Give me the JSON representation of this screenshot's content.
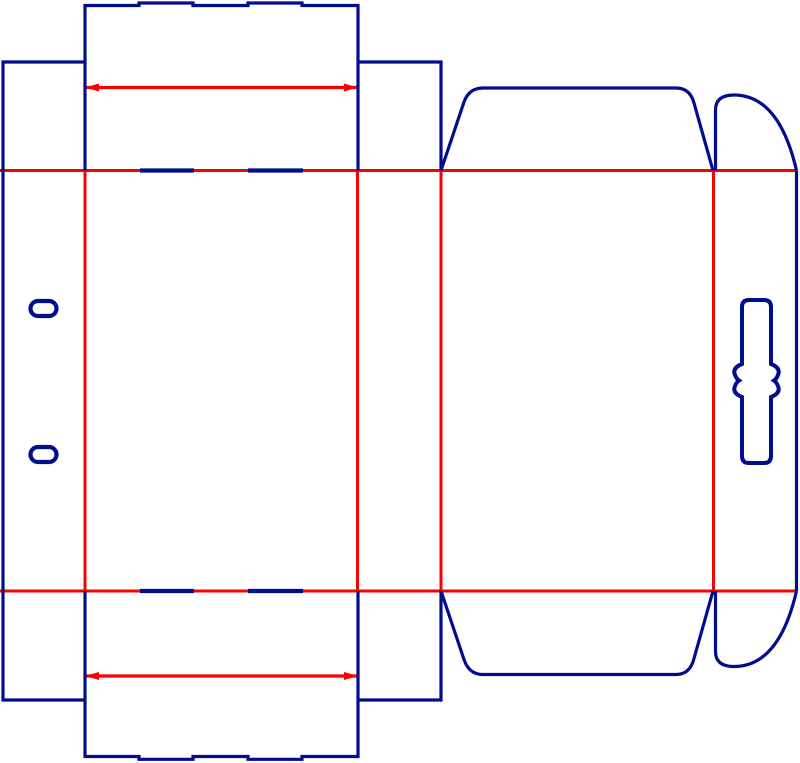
{
  "canvas": {
    "width": 800,
    "height": 763,
    "background": "#ffffff"
  },
  "colors": {
    "cut": "#000d8e",
    "crease": "#fa0000"
  },
  "shapes": [
    {
      "name": "main-crease-top",
      "stroke": "crease",
      "width": 3,
      "d": "M0,170.5 L796.5,170.5"
    },
    {
      "name": "main-crease-bottom",
      "stroke": "crease",
      "width": 3,
      "d": "M0,591 L796.5,591"
    },
    {
      "name": "vertical-crease-glue-front",
      "stroke": "crease",
      "width": 3,
      "d": "M85,170.5 L85,591"
    },
    {
      "name": "vertical-crease-front-side",
      "stroke": "crease",
      "width": 3,
      "d": "M357.5,170.5 L357.5,591"
    },
    {
      "name": "vertical-crease-side-back",
      "stroke": "crease",
      "width": 3,
      "d": "M441,170.5 L441,591"
    },
    {
      "name": "vertical-crease-back-hanger",
      "stroke": "crease",
      "width": 3,
      "d": "M713.5,170.5 L713.5,591"
    },
    {
      "name": "tuck-crease-top",
      "stroke": "crease",
      "width": 3.2,
      "d": "M85,87.5 L358,87.5"
    },
    {
      "name": "tuck-crease-bottom",
      "stroke": "crease",
      "width": 3.2,
      "d": "M85,676 L358,676"
    },
    {
      "name": "tuck-crease-top-arrow-left",
      "fill": "crease",
      "d": "M85,87.5 L99,83.5 L99,91.5 Z"
    },
    {
      "name": "tuck-crease-top-arrow-right",
      "fill": "crease",
      "d": "M358,87.5 L344,83.5 L344,91.5 Z"
    },
    {
      "name": "tuck-crease-bottom-arrow-left",
      "fill": "crease",
      "d": "M85,676 L99,672 L99,680 Z"
    },
    {
      "name": "tuck-crease-bottom-arrow-right",
      "fill": "crease",
      "d": "M358,676 L344,672 L344,680 Z"
    },
    {
      "name": "top-tuck-flap-outline",
      "stroke": "cut",
      "width": 3.2,
      "d": "M85,170.5 L85,5.5 L139,5.5 L139,3 L193,3 L193,5.5 L248,5.5 L248,3 L302,3 L302,5.5 L358,5.5 L358,170.5"
    },
    {
      "name": "bottom-tuck-flap-outline",
      "stroke": "cut",
      "width": 3.2,
      "d": "M85,591 L85,756.5 L139,756.5 L139,759.3 L193,759.3 L193,756.5 L248,756.5 L248,759.3 L302,759.3 L302,756.5 L358,756.5 L358,591"
    },
    {
      "name": "glue-column-outline",
      "stroke": "cut",
      "width": 3.2,
      "d": "M85,62 L3,62 L3,700 L85,700"
    },
    {
      "name": "top-right-dust-flap",
      "stroke": "cut",
      "width": 3.2,
      "d": "M358,62 L441,62 L441,170.5"
    },
    {
      "name": "bottom-right-dust-flap",
      "stroke": "cut",
      "width": 3.2,
      "d": "M358,700 L441,700 L441,591"
    },
    {
      "name": "back-top-flap-outline",
      "stroke": "cut",
      "width": 3.2,
      "d": "M441,170.5 L464,102 Q469,88 483,88 L676,88 Q690,88 694,103 L713,170.5"
    },
    {
      "name": "back-bottom-flap-outline",
      "stroke": "cut",
      "width": 3.2,
      "d": "M441,591 L464,659.5 Q469,674.5 483,674.5 L676,674.5 Q690,674.5 694,658.5 L713,591"
    },
    {
      "name": "top-ear-tab-outline",
      "stroke": "cut",
      "width": 3.2,
      "d": "M715.5,170.5 L715.5,110 Q715.5,95 734,95 Q779,95 796.5,170.5"
    },
    {
      "name": "bottom-ear-tab-outline",
      "stroke": "cut",
      "width": 3.2,
      "d": "M715.5,591 L715.5,651.5 Q715.5,666.5 734,666.5 Q779,666.5 796.5,591"
    },
    {
      "name": "hanger-right-edge",
      "stroke": "cut",
      "width": 3.2,
      "d": "M796.5,170.5 L796.5,591"
    },
    {
      "name": "hang-slot-cutout",
      "stroke": "cut",
      "width": 4,
      "d": "M749,300 L764,300 Q771,300 771,307 L771,364 Q780,367.5 778.5,373.5 Q777,378.5 774,380.5 Q777,382.5 778.5,387.5 Q780,393.5 771,397 L771,456 Q771,463 764,463 L749,463 Q742,463 742,456 L742,397 Q733,393.5 734.5,387.5 Q736,382.5 739,380.5 Q736,378.5 734.5,373.5 Q733,367.5 742,364 L742,307 Q742,300 749,300 Z"
    },
    {
      "name": "glue-slot-top",
      "stroke": "cut",
      "width": 4.2,
      "d": "M38,301 L49,301 A7.5,7.5 0 0 1 49,316 L38,316 A7.5,7.5 0 0 1 38,301 Z"
    },
    {
      "name": "glue-slot-bottom",
      "stroke": "cut",
      "width": 4.2,
      "d": "M38,447 L49,447 A7.5,7.5 0 0 1 49,462 L38,462 A7.5,7.5 0 0 1 38,447 Z"
    },
    {
      "name": "crease-cut-dash-top-left",
      "stroke": "cut",
      "width": 4.2,
      "d": "M140,170.5 L194,170.5"
    },
    {
      "name": "crease-cut-dash-top-right",
      "stroke": "cut",
      "width": 4.2,
      "d": "M248,170.5 L303,170.5"
    },
    {
      "name": "crease-cut-dash-bottom-left",
      "stroke": "cut",
      "width": 4.2,
      "d": "M140,591 L194,591"
    },
    {
      "name": "crease-cut-dash-bottom-right",
      "stroke": "cut",
      "width": 4.2,
      "d": "M248,591 L303,591"
    }
  ]
}
